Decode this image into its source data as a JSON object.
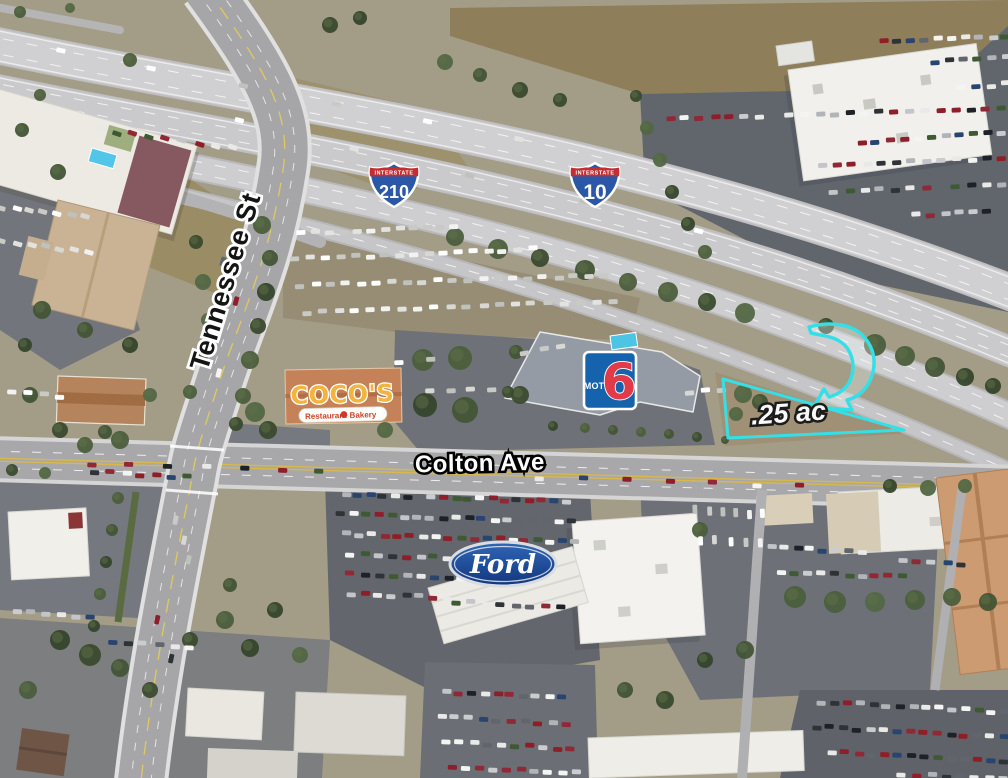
{
  "annotations": {
    "tennessee_label": "Tennessee St",
    "colton_label": "Colton Ave",
    "acreage_label": ".25 ac",
    "highlight_color": "#35dfe6"
  },
  "shields": {
    "i210": {
      "banner": "INTERSTATE",
      "number": "210"
    },
    "i10": {
      "banner": "INTERSTATE",
      "number": "10"
    }
  },
  "logos": {
    "cocos": {
      "name": "COCO'S",
      "left": "Restaurant",
      "right": "Bakery"
    },
    "motel6": {
      "word": "MOTEL",
      "digit": "6"
    },
    "ford": {
      "script": "Ford"
    }
  }
}
